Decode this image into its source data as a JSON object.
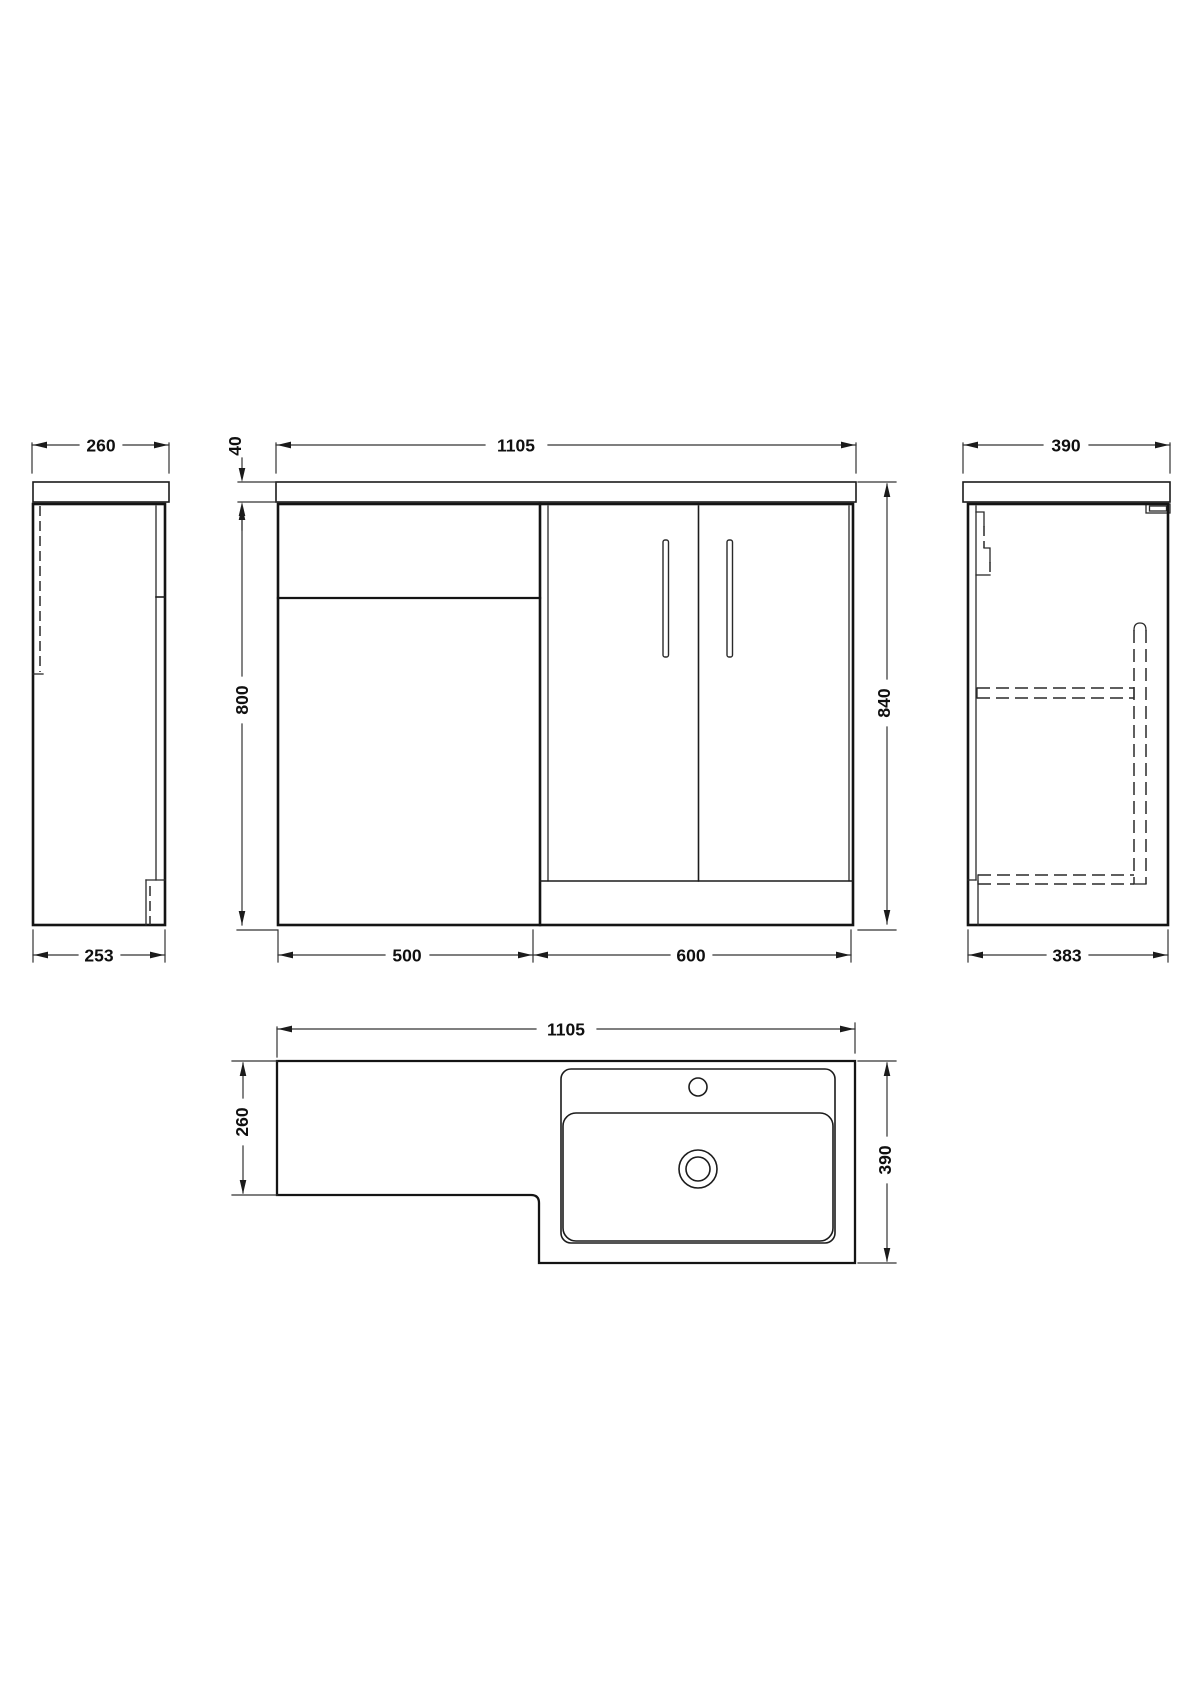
{
  "drawing": {
    "type": "bathroom furniture dimension drawing",
    "units": "mm",
    "colors": {
      "background": "#ffffff",
      "line": "#1b1b1b"
    },
    "views": {
      "left_side": {
        "top_width": "260",
        "base_width": "253"
      },
      "front": {
        "overall_width": "1105",
        "worktop_thickness": "40",
        "cabinet_height": "800",
        "overall_height": "840",
        "wc_unit_width": "500",
        "basin_unit_width": "600"
      },
      "right_side": {
        "top_depth": "390",
        "base_depth": "383"
      },
      "plan": {
        "overall_width": "1105",
        "left_section_depth": "260",
        "overall_depth": "390"
      }
    }
  }
}
